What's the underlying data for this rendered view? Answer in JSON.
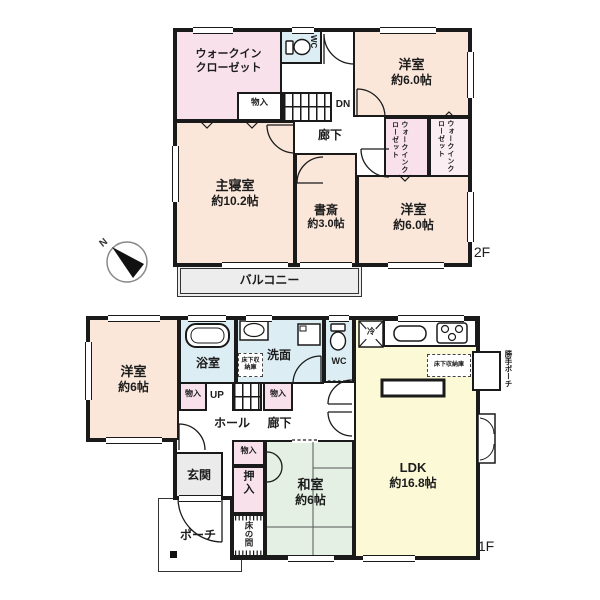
{
  "colors": {
    "wall": "#1a1a1a",
    "text": "#1c1c1c",
    "room-peach": "#fae7da",
    "room-pink": "#f8e1eb",
    "room-blue": "#dcedf4",
    "room-yellow": "#fcf9d7",
    "room-green": "#e4f0e4",
    "room-gray": "#ededed",
    "entry-gray": "#ebebeb"
  },
  "compass": {
    "north_label": "N"
  },
  "f2": {
    "floor_label": "2F",
    "walkin_closet": {
      "line1": "ウォークイン",
      "line2": "クローゼット"
    },
    "wc": {
      "label": "WC"
    },
    "storage": {
      "label": "物入"
    },
    "stairs": {
      "label": "DN"
    },
    "corridor": {
      "label": "廊下"
    },
    "bedroom_ne": {
      "label": "洋室",
      "size": "約6.0帖"
    },
    "wic_a": {
      "label": "ウォークインクローゼット"
    },
    "wic_b": {
      "label": "ウォークインクローゼット"
    },
    "master_bedroom": {
      "label": "主寝室",
      "size": "約10.2帖"
    },
    "study": {
      "label": "書斎",
      "size": "約3.0帖"
    },
    "bedroom_se": {
      "label": "洋室",
      "size": "約6.0帖"
    },
    "balcony": {
      "label": "バルコニー"
    }
  },
  "f1": {
    "floor_label": "1F",
    "bedroom": {
      "label": "洋室",
      "size": "約6帖"
    },
    "bath": {
      "label": "浴室"
    },
    "washroom": {
      "label": "洗面"
    },
    "wc": {
      "label": "WC"
    },
    "underfloor_storage_hall": {
      "label": "床下収納庫"
    },
    "underfloor_storage_kitchen": {
      "label": "床下収納庫"
    },
    "stairs": {
      "label": "UP"
    },
    "hall": {
      "label": "ホール"
    },
    "corridor": {
      "label": "廊下"
    },
    "storage_a": {
      "label": "物入"
    },
    "storage_b": {
      "label": "物入"
    },
    "storage_c": {
      "label": "物入"
    },
    "entrance": {
      "label": "玄関"
    },
    "porch": {
      "label": "ポーチ"
    },
    "closet": {
      "label": "押入"
    },
    "tokonoma": {
      "label": "床の間"
    },
    "washitsu": {
      "label": "和室",
      "size": "約6帖"
    },
    "ldk": {
      "label": "LDK",
      "size": "約16.8帖"
    },
    "refrigerator": {
      "label": "冷"
    },
    "side_porch": {
      "label": "勝手ポーチ"
    }
  }
}
